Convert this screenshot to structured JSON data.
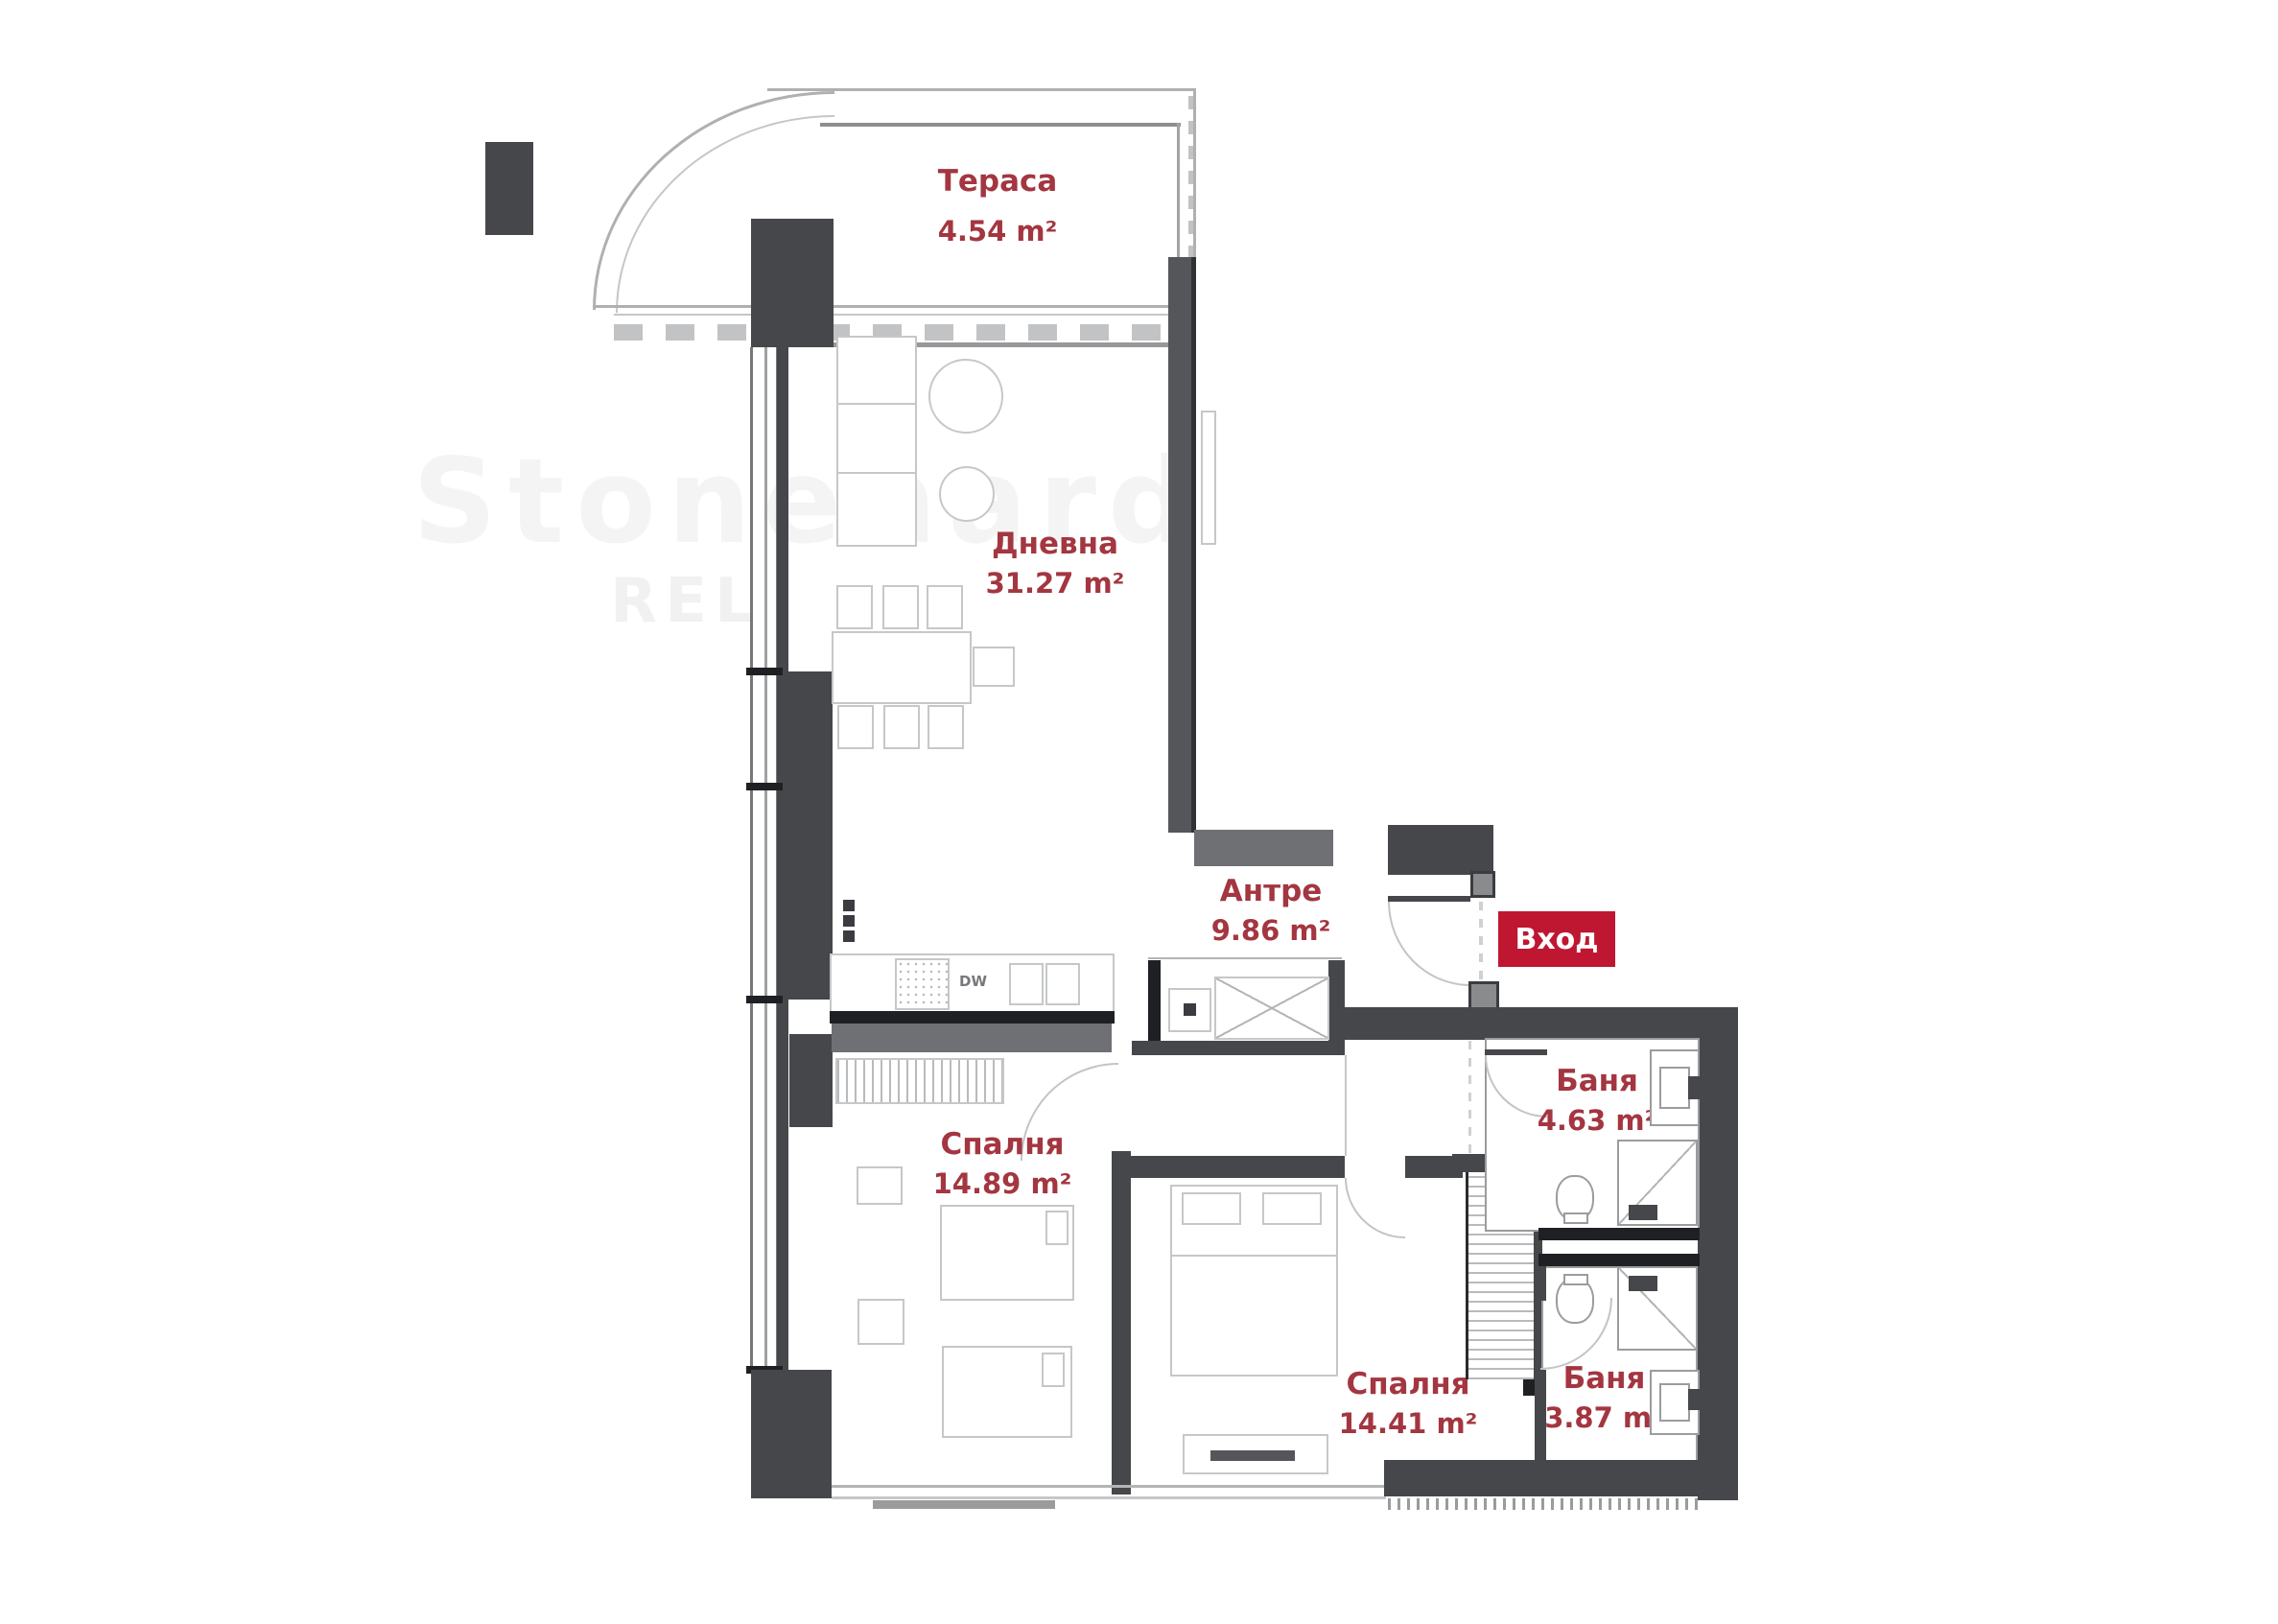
{
  "plan": {
    "type": "apartment-floor-plan",
    "language": "Bulgarian",
    "rooms": {
      "terrace": {
        "name": "Тераса",
        "area": "4.54 m²"
      },
      "living": {
        "name": "Дневна",
        "area": "31.27 m²"
      },
      "hallway": {
        "name": "Антре",
        "area": "9.86 m²"
      },
      "bath1": {
        "name": "Баня",
        "area": "4.63 m²"
      },
      "bedroom1": {
        "name": "Спалня",
        "area": "14.89 m²"
      },
      "bedroom2": {
        "name": "Спалня",
        "area": "14.41 m²"
      },
      "bath2": {
        "name": "Баня",
        "area": "3.87 m²"
      }
    },
    "entrance": {
      "label": "Вход"
    },
    "kitchen": {
      "dishwasher_label": "DW"
    },
    "watermark": {
      "line1": "Stonehard",
      "line2": "REL"
    },
    "colors": {
      "wall_dark": "#46474b",
      "wall_black": "#1f2024",
      "wall_mid": "#6f7074",
      "wall_light": "#a9abad",
      "furniture_line": "#c6c7c9",
      "plan_line": "#b3b4b6",
      "label_text": "#a33640",
      "badge_bg": "#bf1731",
      "badge_text": "#ffffff"
    }
  }
}
